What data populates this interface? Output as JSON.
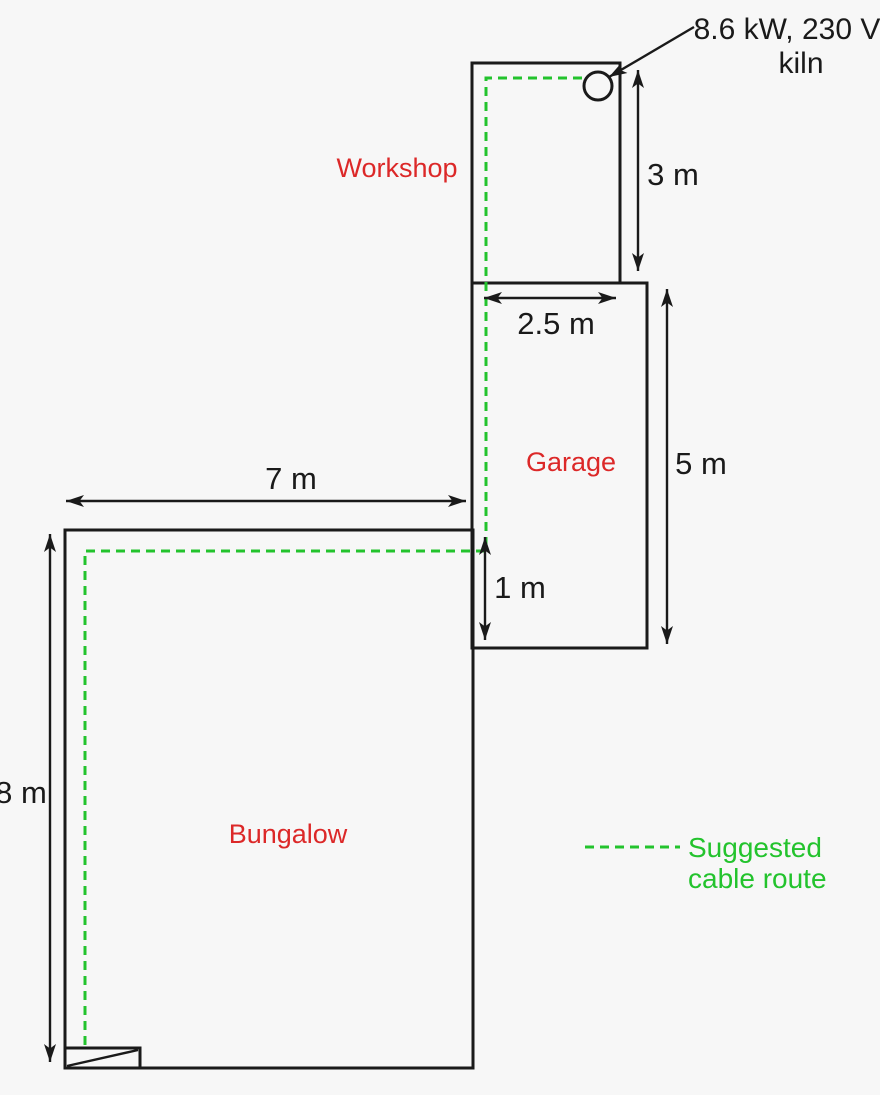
{
  "colors": {
    "bg": "#f7f7f7",
    "ink": "#1a1a1a",
    "red": "#dc2828",
    "green": "#23c32d"
  },
  "buildings": {
    "workshop": "Workshop",
    "garage": "Garage",
    "bungalow": "Bungalow"
  },
  "dimensions": {
    "bungalow_width": "7 m",
    "bungalow_height": "8 m",
    "workshop_height": "3 m",
    "workshop_width": "2.5 m",
    "garage_height": "5 m",
    "garage_bungalow_overlap": "1 m"
  },
  "kiln": {
    "rating": "8.6 kW, 230 V",
    "name": "kiln"
  },
  "legend": {
    "line1": "Suggested",
    "line2": "cable route"
  }
}
